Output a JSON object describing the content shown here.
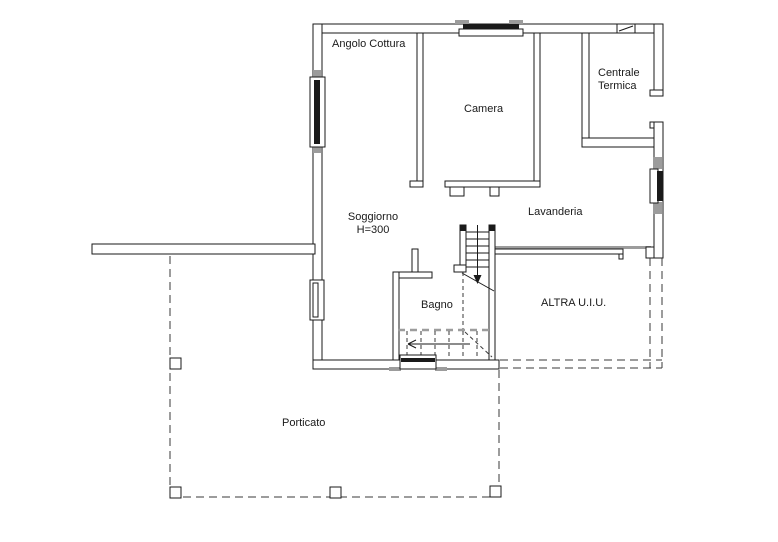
{
  "colors": {
    "wall": "#1a1a1a",
    "gray": "#9c9c9c",
    "dash": "#3a3a3a",
    "bg": "#ffffff"
  },
  "rooms": {
    "angolo_cottura": "Angolo Cottura",
    "camera": "Camera",
    "centrale_termica": "Centrale Termica",
    "soggiorno": "Soggiorno",
    "soggiorno_height": "H=300",
    "lavanderia": "Lavanderia",
    "bagno": "Bagno",
    "altra_uiu": "ALTRA U.I.U.",
    "porticato": "Porticato"
  }
}
